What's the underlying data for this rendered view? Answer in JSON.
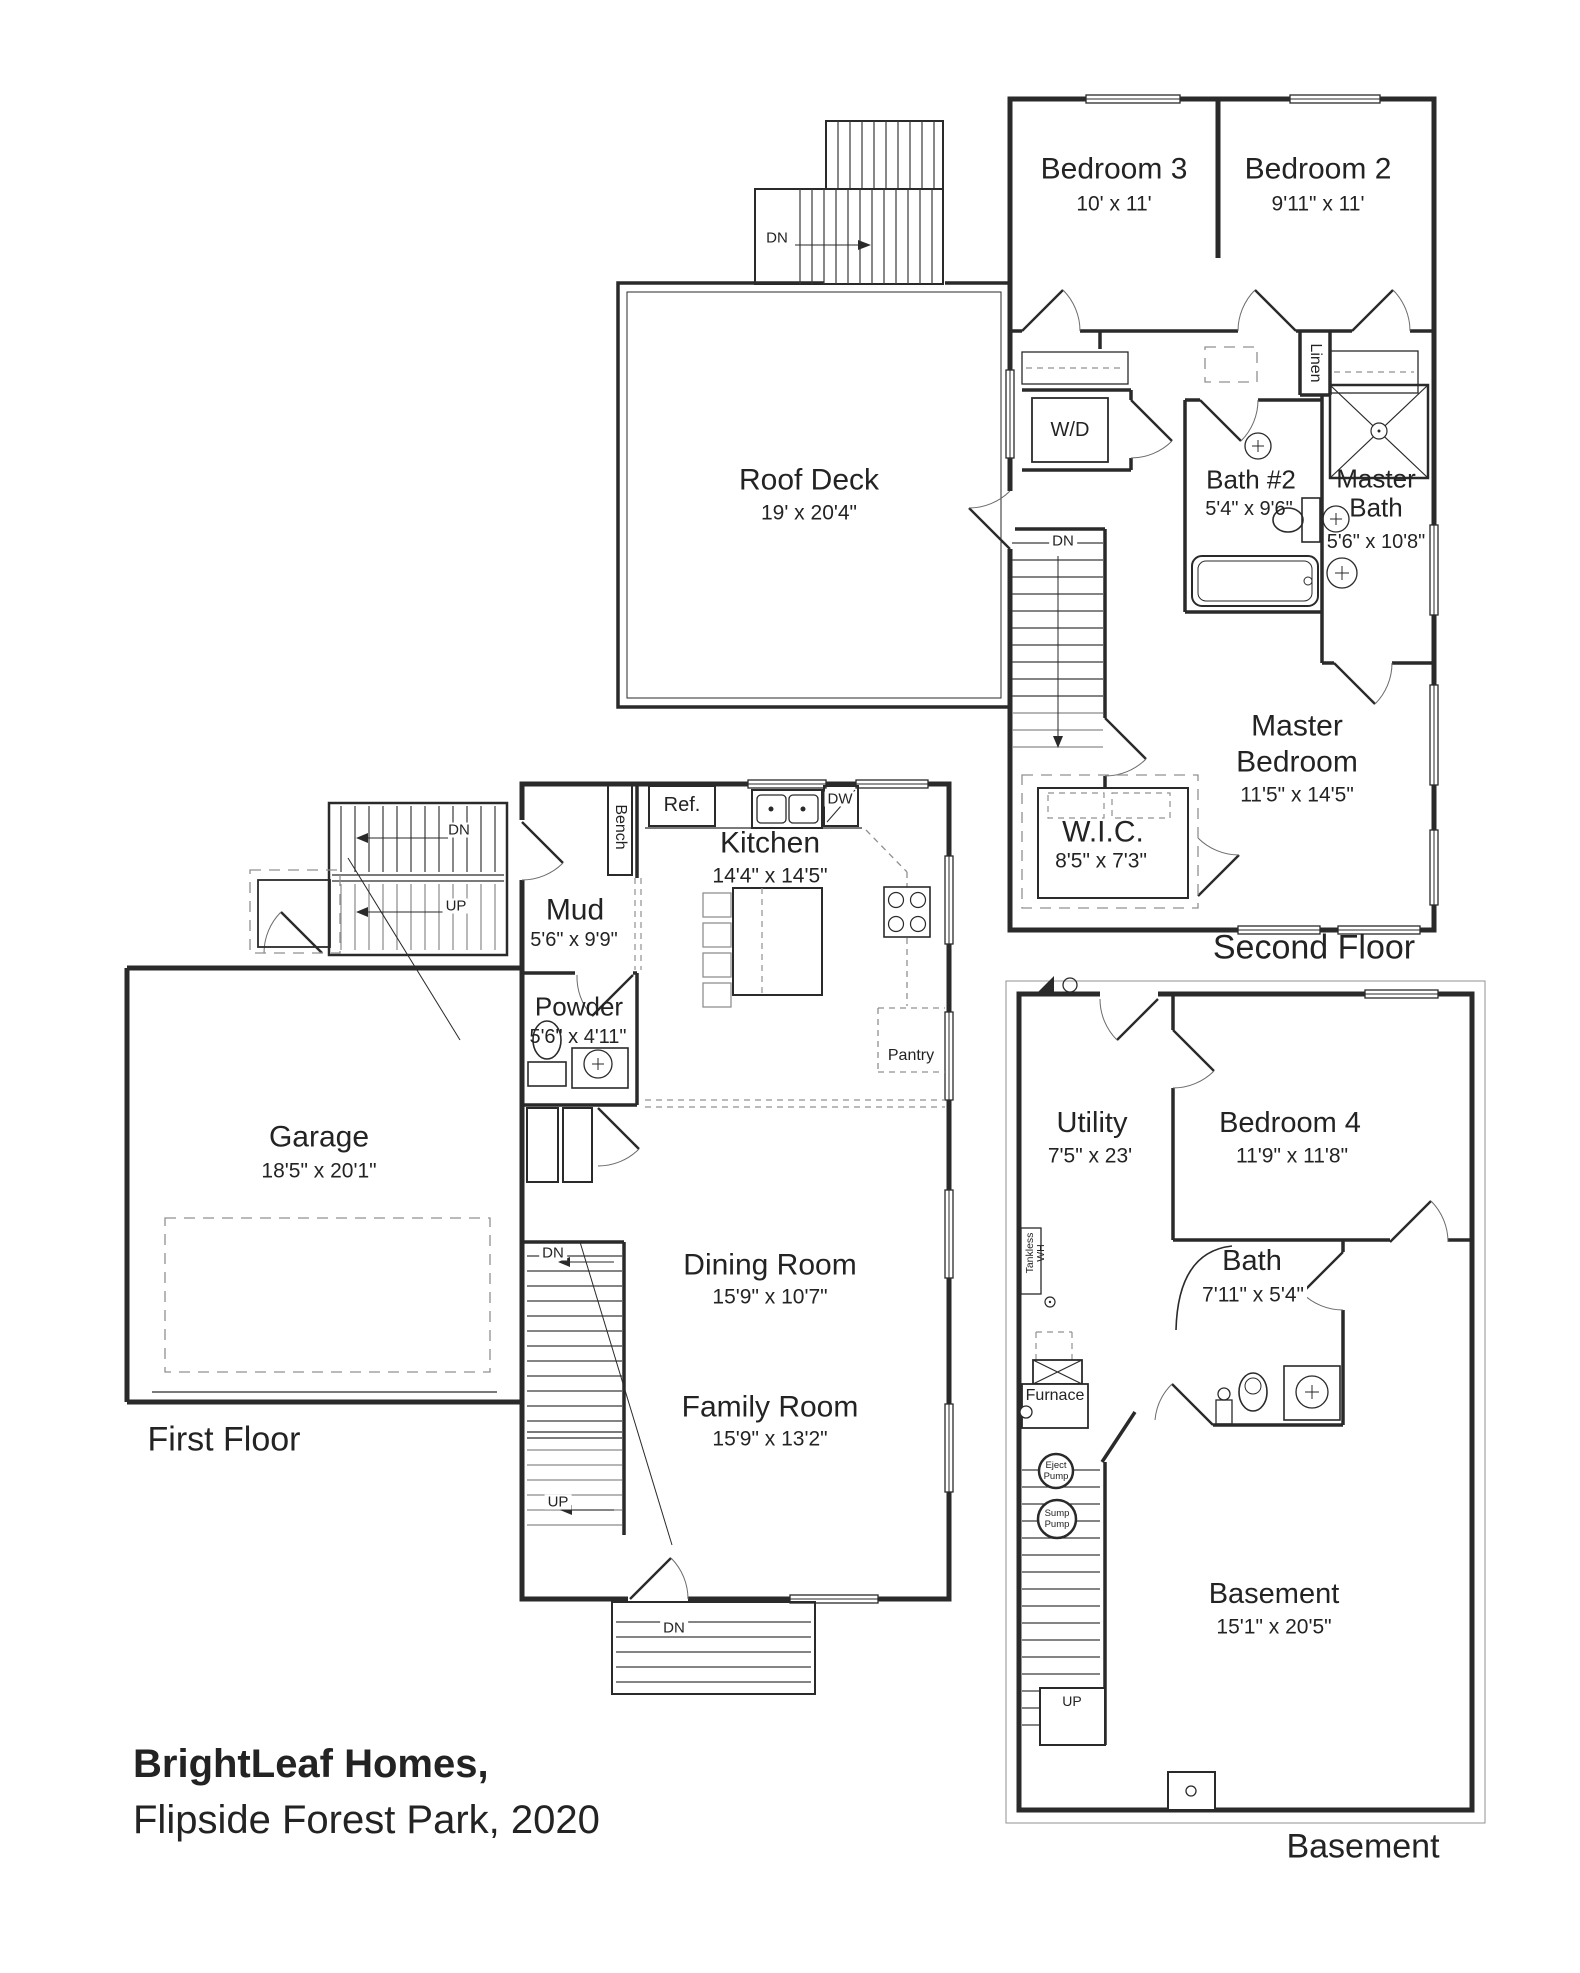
{
  "title": {
    "line1": "BrightLeaf Homes,",
    "line2": "Flipside Forest Park, 2020"
  },
  "floor_labels": {
    "second": "Second Floor",
    "first": "First Floor",
    "basement": "Basement"
  },
  "stair_labels": {
    "dn": "DN",
    "up": "UP"
  },
  "second_floor": {
    "bedroom3": {
      "name": "Bedroom 3",
      "dims": "10' x 11'"
    },
    "bedroom2": {
      "name": "Bedroom 2",
      "dims": "9'11\" x 11'"
    },
    "bath2": {
      "name": "Bath #2",
      "dims": "5'4\" x 9'6\""
    },
    "master_bath": {
      "line1": "Master",
      "line2": "Bath",
      "dims": "5'6\" x 10'8\""
    },
    "master_bedroom": {
      "line1": "Master",
      "line2": "Bedroom",
      "dims": "11'5\" x 14'5\""
    },
    "wic": {
      "name": "W.I.C.",
      "dims": "8'5\" x 7'3\""
    },
    "wd": "W/D",
    "linen": "Linen"
  },
  "roof": {
    "deck": {
      "name": "Roof Deck",
      "dims": "19' x 20'4\""
    }
  },
  "first_floor": {
    "garage": {
      "name": "Garage",
      "dims": "18'5\" x 20'1\""
    },
    "mud": {
      "name": "Mud",
      "dims": "5'6\" x 9'9\""
    },
    "powder": {
      "name": "Powder",
      "dims": "5'6\" x 4'11\""
    },
    "kitchen": {
      "name": "Kitchen",
      "dims": "14'4\" x 14'5\""
    },
    "dining": {
      "name": "Dining Room",
      "dims": "15'9\" x 10'7\""
    },
    "family": {
      "name": "Family Room",
      "dims": "15'9\" x 13'2\""
    },
    "ref": "Ref.",
    "dw": "DW",
    "bench": "Bench",
    "pantry": "Pantry"
  },
  "basement_floor": {
    "utility": {
      "name": "Utility",
      "dims": "7'5\" x 23'"
    },
    "bedroom4": {
      "name": "Bedroom 4",
      "dims": "11'9\" x 11'8\""
    },
    "bath": {
      "name": "Bath",
      "dims": "7'11\" x 5'4\""
    },
    "basement": {
      "name": "Basement",
      "dims": "15'1\" x 20'5\""
    },
    "tankless": {
      "line1": "Tankless",
      "line2": "WH"
    },
    "furnace": "Furnace",
    "eject_pump": {
      "line1": "Eject",
      "line2": "Pump"
    },
    "sump_pump": {
      "line1": "Sump",
      "line2": "Pump"
    }
  }
}
